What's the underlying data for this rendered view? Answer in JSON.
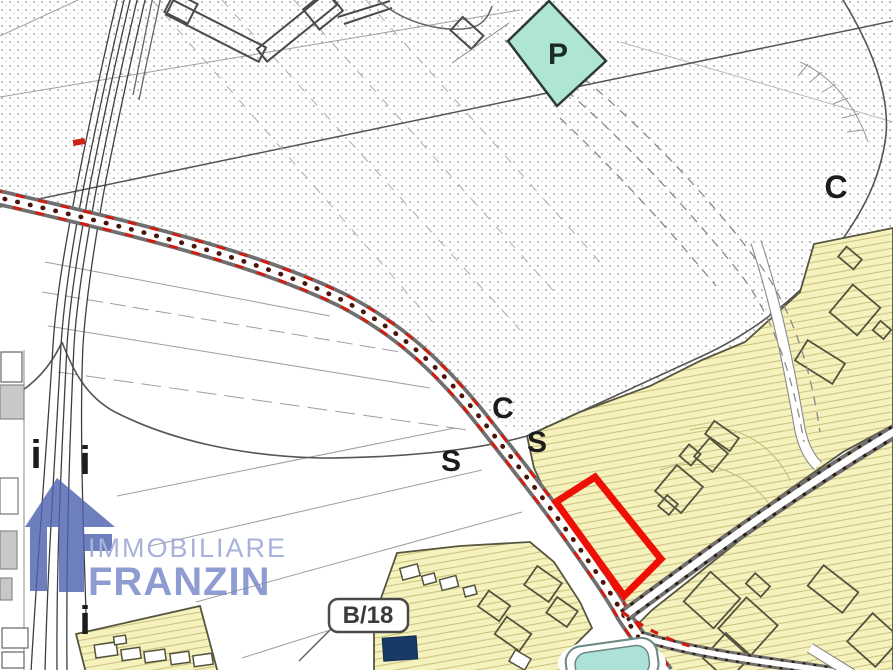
{
  "page": {
    "title": "Urban zoning plan with highlighted parcel"
  },
  "map": {
    "labels": {
      "parking": "P",
      "zone_c_upper": "C",
      "zone_c_lower": "C",
      "zone_s_left": "S",
      "zone_s_right": "S",
      "marker_i_1": "i",
      "marker_i_2": "i",
      "marker_i_3": "i"
    },
    "parcel_label": "B/18",
    "colors": {
      "zone_yellow": "#f6f2bd",
      "zone_hatch": "#cbc282",
      "zone_teal": "#aee6d2",
      "pool_teal": "#ade2d8",
      "highlight_red": "#ee1005",
      "road_dash_red": "#d31a0c",
      "road_dot_brown": "#4a140b",
      "navy_building": "#173a66",
      "logo_blue": "#4f63b0"
    }
  },
  "watermark": {
    "line1": "IMMOBILIARE",
    "line2": "FRANZIN"
  }
}
